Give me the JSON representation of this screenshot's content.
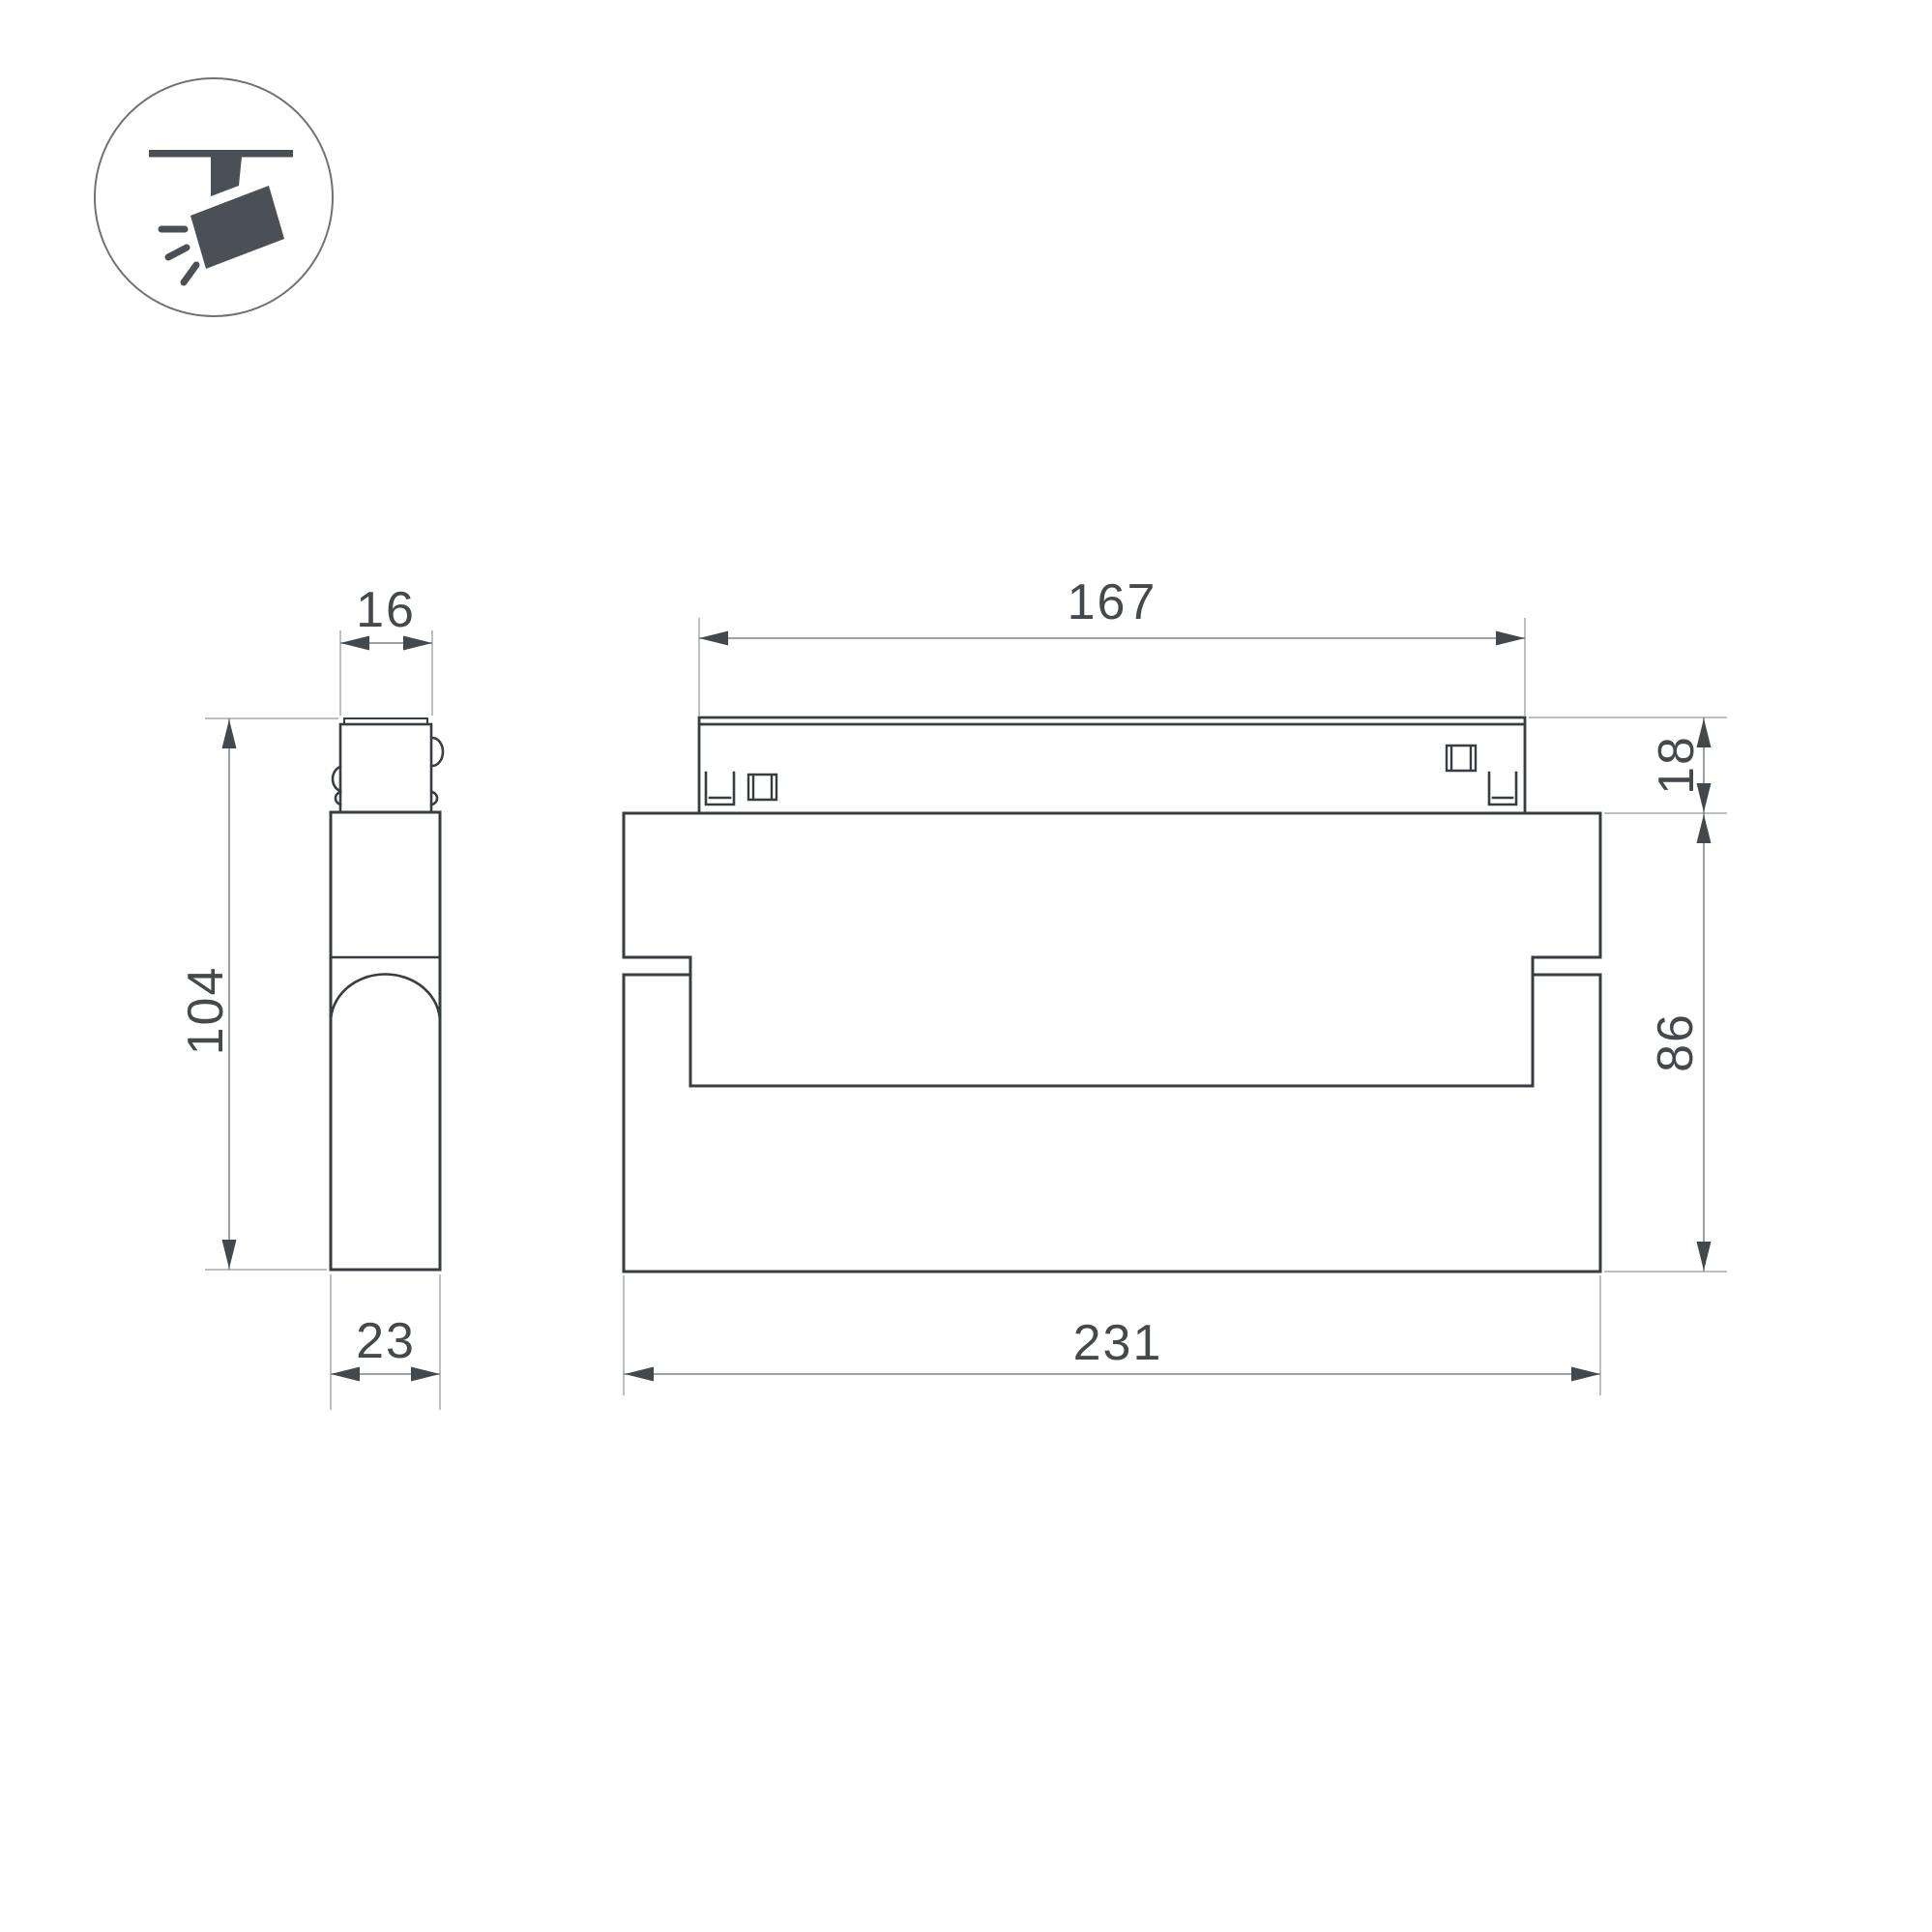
{
  "icon": {
    "name": "ceiling-track-spotlight",
    "fill_color": "#4a5055",
    "circle_color": "#6d7377"
  },
  "drawing": {
    "line_color": "#383d42",
    "dim_line_color": "#7d8286",
    "ext_line_color": "#a6abae",
    "arrow_color": "#43484d",
    "text_color": "#45494e"
  },
  "dimensions": {
    "side_top_width": "16",
    "side_height": "104",
    "side_depth": "23",
    "front_top_width": "167",
    "front_top_height": "18",
    "front_body_height": "86",
    "front_total_width": "231"
  }
}
